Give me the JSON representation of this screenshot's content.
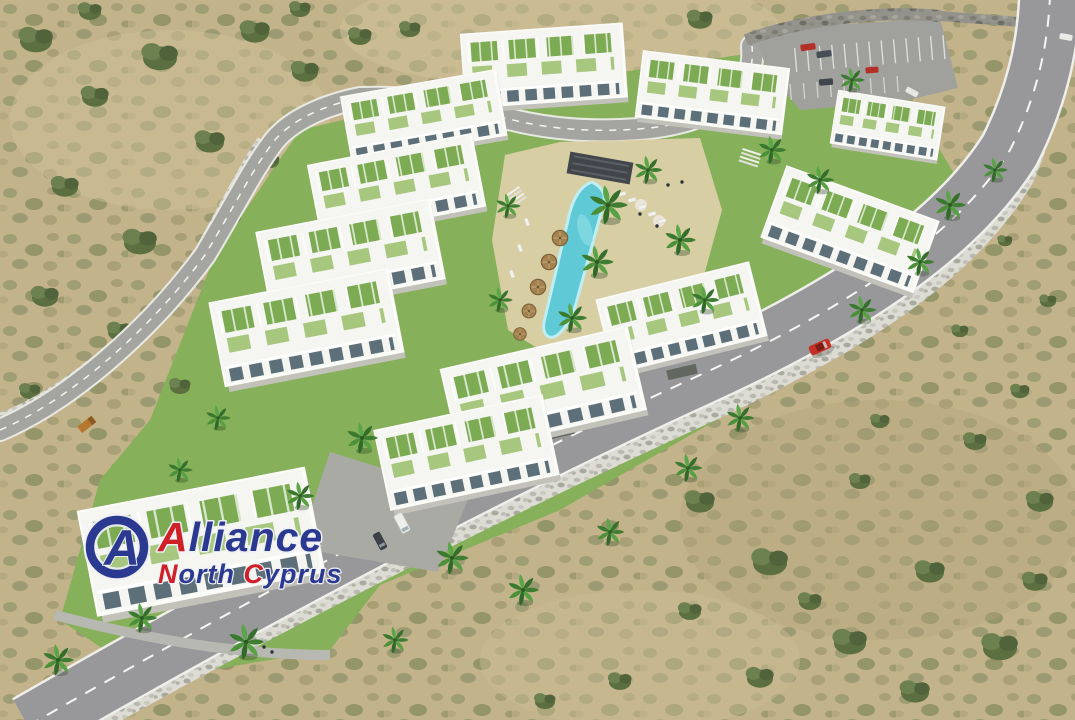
{
  "watermark": {
    "brand": "Alliance North Cyprus",
    "emblem_letter": "A",
    "line1": {
      "initial": "A",
      "rest": "lliance"
    },
    "line2": {
      "word1_initial": "N",
      "word1_rest": "orth ",
      "word2_initial": "C",
      "word2_rest": "yprus"
    }
  },
  "colors": {
    "logo-blue": "#2b3990",
    "logo-red": "#cf2027",
    "pool-water": "#5fc9d6",
    "lawn-green": "#86b15a",
    "roof-green": "#7cab54",
    "building-white": "#f5f5f1",
    "sand-scrub": "#c3b38b",
    "asphalt": "#98989b",
    "car-red": "#c62f23"
  }
}
